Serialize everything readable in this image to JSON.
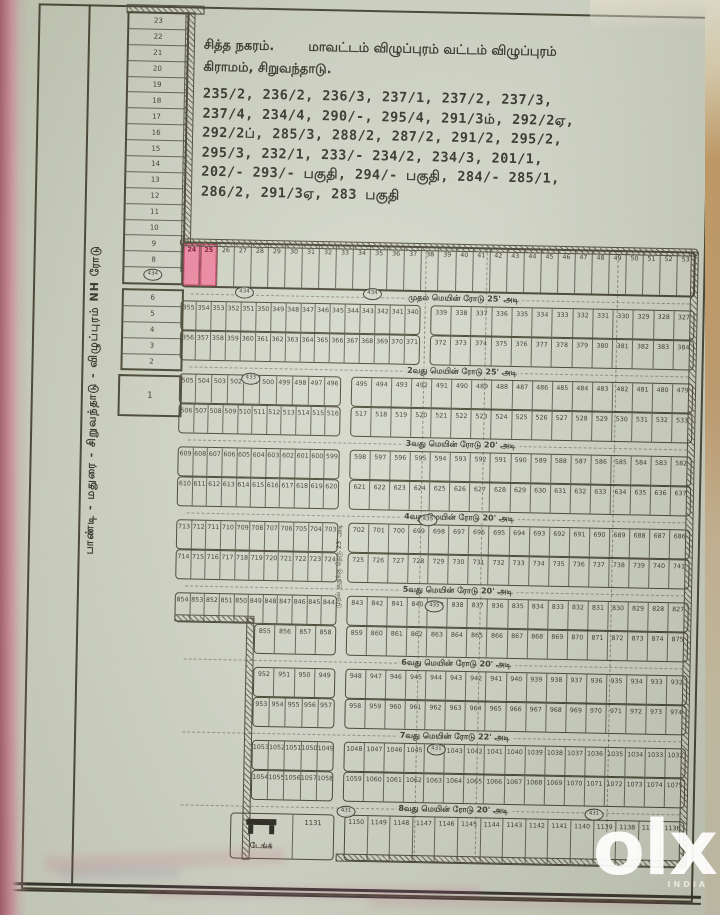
{
  "document": {
    "title_left": "சித்த நகரம்.",
    "title_right": "மாவட்டம் விழுப்புரம்  வட்டம் விழுப்புரம்",
    "subtitle": "கிராமம், சிறுவந்தாடு.",
    "survey_numbers": [
      "235/2, 236/2, 236/3, 237/1, 237/2, 237/3,",
      "237/4, 234/4, 290/-, 295/4, 291/3ம், 292/2ஏ,",
      "292/2ப், 285/3, 288/2, 287/2, 291/2, 295/2,",
      "295/3, 232/1, 233/- 234/2, 234/3, 201/1,",
      "202/- 293/- பகுதி, 294/- பகுதி, 284/- 285/1,",
      "286/2, 291/3ஏ, 283 பகுதி"
    ],
    "nh_road_label": "பாண்டி - மதுரை - சிறுவந்தாடு - விழுப்புரம் NH ரோடு",
    "cross_street_label": "முதல் குறுக்கு தெரு 23' அடி"
  },
  "left_strip": {
    "upper_plots": [
      "23",
      "22",
      "21",
      "20",
      "19",
      "18",
      "17",
      "16",
      "15",
      "14",
      "13",
      "12",
      "11",
      "10",
      "9",
      "8",
      "7"
    ],
    "upper_highlighted": [
      "7"
    ],
    "mid_plots": [
      "6",
      "5",
      "4",
      "3",
      "2"
    ],
    "lone_plot": "1"
  },
  "top_row": {
    "plots": [
      "24",
      "25",
      "26",
      "27",
      "28",
      "29",
      "30",
      "31",
      "32",
      "33",
      "34",
      "35",
      "36",
      "37",
      "38",
      "39",
      "40",
      "41",
      "42",
      "43",
      "44",
      "45",
      "46",
      "47",
      "48",
      "49",
      "50",
      "51",
      "52",
      "53"
    ],
    "highlighted": [
      "24",
      "25"
    ]
  },
  "bands": [
    {
      "road_label": "முதல் மெயின் ரோடு 25' அடி",
      "rows": [
        {
          "indent": "wide",
          "left": [
            "355",
            "354",
            "353",
            "352",
            "351",
            "350",
            "349",
            "348",
            "347",
            "346",
            "345",
            "344",
            "343",
            "342",
            "341",
            "340"
          ],
          "right": [
            "339",
            "338",
            "337",
            "336",
            "335",
            "334",
            "333",
            "332",
            "331",
            "330",
            "329",
            "328",
            "327"
          ]
        },
        {
          "indent": "wide",
          "left": [
            "356",
            "357",
            "358",
            "359",
            "360",
            "361",
            "362",
            "363",
            "364",
            "365",
            "366",
            "367",
            "368",
            "369",
            "370",
            "371"
          ],
          "right": [
            "372",
            "373",
            "374",
            "375",
            "376",
            "377",
            "378",
            "379",
            "380",
            "381",
            "382",
            "383",
            "384"
          ]
        }
      ]
    },
    {
      "road_label": "2வது மெயின் ரோடு 25' அடி",
      "rows": [
        {
          "indent": "normal",
          "left": [
            "505",
            "504",
            "503",
            "502",
            "501",
            "500",
            "499",
            "498",
            "497",
            "496"
          ],
          "right": [
            "495",
            "494",
            "493",
            "492",
            "491",
            "490",
            "489",
            "488",
            "487",
            "486",
            "485",
            "484",
            "483",
            "482",
            "481",
            "480",
            "479"
          ]
        },
        {
          "indent": "normal",
          "left": [
            "506",
            "507",
            "508",
            "509",
            "510",
            "511",
            "512",
            "513",
            "514",
            "515",
            "516"
          ],
          "right": [
            "517",
            "518",
            "519",
            "520",
            "521",
            "522",
            "523",
            "524",
            "525",
            "526",
            "527",
            "528",
            "529",
            "530",
            "531",
            "532",
            "533"
          ]
        }
      ]
    },
    {
      "road_label": "3வது மெயின் ரோடு 20' அடி",
      "rows": [
        {
          "indent": "normal",
          "left": [
            "609",
            "608",
            "607",
            "606",
            "605",
            "604",
            "603",
            "602",
            "601",
            "600",
            "599"
          ],
          "right": [
            "598",
            "597",
            "596",
            "595",
            "594",
            "593",
            "592",
            "591",
            "590",
            "589",
            "588",
            "587",
            "586",
            "585",
            "584",
            "583",
            "582"
          ]
        },
        {
          "indent": "normal",
          "left": [
            "610",
            "611",
            "612",
            "613",
            "614",
            "615",
            "616",
            "617",
            "618",
            "619",
            "620"
          ],
          "right": [
            "621",
            "622",
            "623",
            "624",
            "625",
            "626",
            "627",
            "628",
            "629",
            "630",
            "631",
            "632",
            "633",
            "634",
            "635",
            "636",
            "637"
          ]
        }
      ]
    },
    {
      "road_label": "4வது மெயின் ரோடு 20' அடி",
      "rows": [
        {
          "indent": "normal",
          "left": [
            "713",
            "712",
            "711",
            "710",
            "709",
            "708",
            "707",
            "706",
            "705",
            "704",
            "703"
          ],
          "right": [
            "702",
            "701",
            "700",
            "699",
            "698",
            "697",
            "696",
            "695",
            "694",
            "693",
            "692",
            "691",
            "690",
            "689",
            "688",
            "687",
            "686"
          ]
        },
        {
          "indent": "normal",
          "left": [
            "714",
            "715",
            "716",
            "717",
            "718",
            "719",
            "720",
            "721",
            "722",
            "723",
            "724"
          ],
          "right": [
            "725",
            "726",
            "727",
            "728",
            "729",
            "730",
            "731",
            "732",
            "733",
            "734",
            "735",
            "736",
            "737",
            "738",
            "739",
            "740",
            "741"
          ]
        }
      ]
    },
    {
      "road_label": "5வது மெயின் ரோடு 20' அடி",
      "rows": [
        {
          "indent": "normal",
          "left": [
            "854",
            "853",
            "852",
            "851",
            "850",
            "849",
            "848",
            "847",
            "846",
            "845",
            "844"
          ],
          "right": [
            "843",
            "842",
            "841",
            "840",
            "839",
            "838",
            "837",
            "836",
            "835",
            "834",
            "833",
            "832",
            "831",
            "830",
            "829",
            "828",
            "827"
          ]
        },
        {
          "indent": "short",
          "left": [
            "855",
            "856",
            "857",
            "858"
          ],
          "right": [
            "859",
            "860",
            "861",
            "862",
            "863",
            "864",
            "865",
            "866",
            "867",
            "868",
            "869",
            "870",
            "871",
            "872",
            "873",
            "874",
            "875"
          ]
        }
      ]
    },
    {
      "road_label": "6வது மெயின் ரோடு 20' அடி",
      "rows": [
        {
          "indent": "short",
          "left": [
            "952",
            "951",
            "950",
            "949"
          ],
          "right": [
            "948",
            "947",
            "946",
            "945",
            "944",
            "943",
            "942",
            "941",
            "940",
            "939",
            "938",
            "937",
            "936",
            "935",
            "934",
            "933",
            "932"
          ]
        },
        {
          "indent": "short",
          "left": [
            "953",
            "954",
            "955",
            "956",
            "957"
          ],
          "right": [
            "958",
            "959",
            "960",
            "961",
            "962",
            "963",
            "964",
            "965",
            "966",
            "967",
            "968",
            "969",
            "970",
            "971",
            "972",
            "973",
            "974"
          ]
        }
      ]
    },
    {
      "road_label": "7வது மெயின் ரோடு 22' அடி",
      "rows": [
        {
          "indent": "short",
          "left": [
            "1053",
            "1052",
            "1051",
            "1050",
            "1049"
          ],
          "right": [
            "1048",
            "1047",
            "1046",
            "1045",
            "1044",
            "1043",
            "1042",
            "1041",
            "1040",
            "1039",
            "1038",
            "1037",
            "1036",
            "1035",
            "1034",
            "1033",
            "1032"
          ]
        },
        {
          "indent": "short",
          "left": [
            "1054",
            "1055",
            "1056",
            "1057",
            "1058"
          ],
          "right": [
            "1059",
            "1060",
            "1061",
            "1062",
            "1063",
            "1064",
            "1065",
            "1066",
            "1067",
            "1068",
            "1069",
            "1070",
            "1071",
            "1072",
            "1073",
            "1074",
            "1075"
          ]
        }
      ]
    }
  ],
  "bottom": {
    "road_label": "8வது மெயின் ரோடு 20' அடி",
    "tank_label": "டேங்க்",
    "tank_plot": "1131",
    "plots": [
      "1150",
      "1149",
      "1148",
      "1147",
      "1146",
      "1145",
      "1144",
      "1143",
      "1142",
      "1141",
      "1140",
      "1139",
      "1138",
      "1137",
      "1136"
    ]
  },
  "markers": [
    "434",
    "434",
    "434",
    "433",
    "435",
    "435",
    "431",
    "431",
    "431"
  ],
  "watermark": {
    "logo": "olx",
    "country": "INDIA"
  },
  "colors": {
    "highlight": "#ee87a1",
    "ink": "#45422f",
    "paper": "#d0d4c4"
  }
}
